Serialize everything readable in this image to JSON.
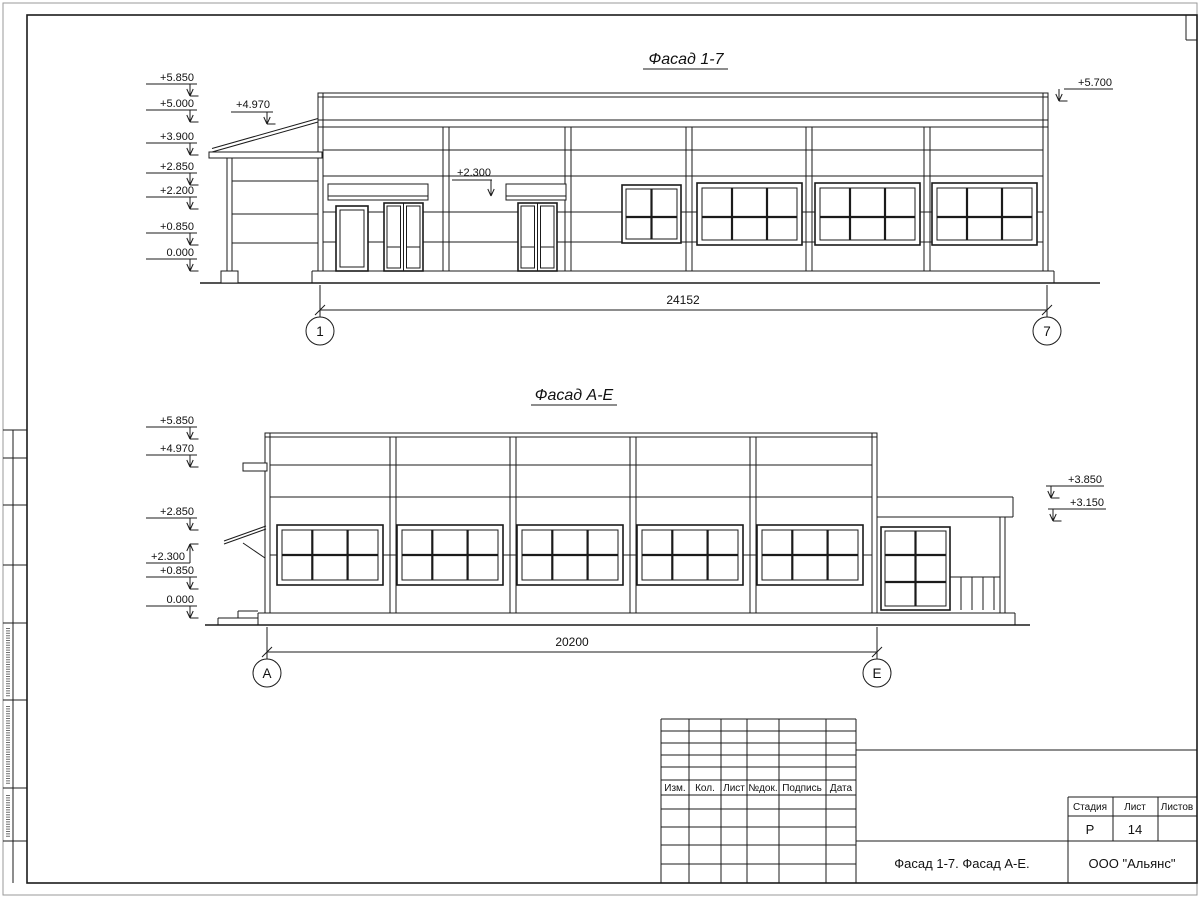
{
  "drawing": {
    "ink_color": "#1b1b1b",
    "f17": {
      "title": "Фасад 1-7",
      "marks": [
        "+5.850",
        "+5.000",
        "+3.900",
        "+2.850",
        "+2.200",
        "+0.850",
        "0.000"
      ],
      "porch_mark": "+4.970",
      "canopy_mark": "+2.300",
      "parapet_mark": "+5.700",
      "dim": "24152",
      "axis_left": "1",
      "axis_right": "7"
    },
    "fae": {
      "title": "Фасад А-Е",
      "marks": [
        "+5.850",
        "+4.970",
        "+2.850",
        "+2.300",
        "+0.850",
        "0.000"
      ],
      "right_marks": [
        "+3.850",
        "+3.150"
      ],
      "dim": "20200",
      "axis_left": "А",
      "axis_right": "Е"
    },
    "title_block": {
      "columns": [
        "Изм.",
        "Кол.",
        "Лист",
        "№док.",
        "Подпись",
        "Дата"
      ],
      "stage_label": "Стадия",
      "sheet_label": "Лист",
      "sheets_label": "Листов",
      "stage_value": "Р",
      "sheet_value": "14",
      "sheets_value": "",
      "drawing_name": "Фасад 1-7. Фасад А-Е.",
      "organization": "ООО \"Альянс\""
    }
  }
}
